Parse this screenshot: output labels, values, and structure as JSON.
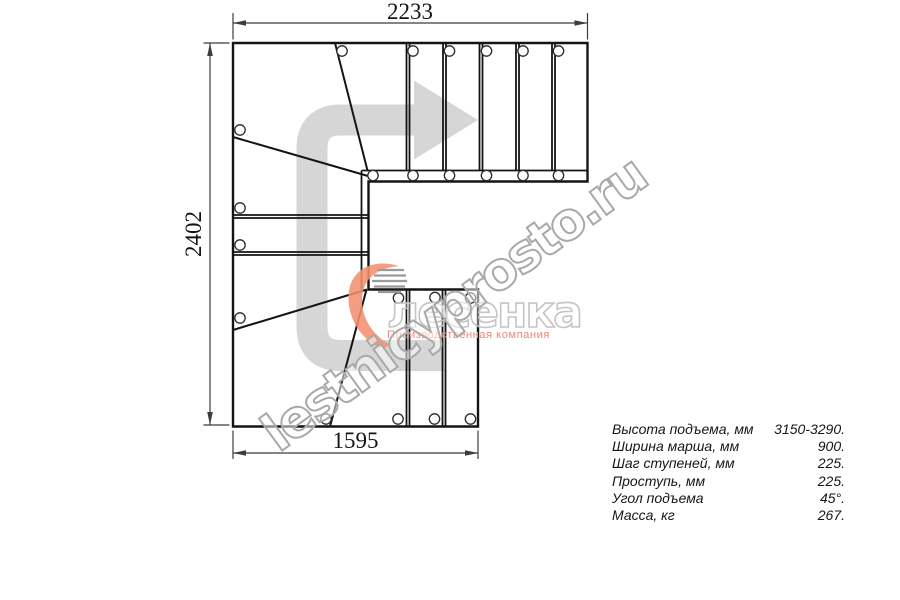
{
  "plan": {
    "dim_top": "2233",
    "dim_left": "2402",
    "dim_bottom": "1595"
  },
  "logo": {
    "title": "лесенка",
    "subtitle": "Производственная компания"
  },
  "watermark": {
    "text": "lestnicyprosto.ru"
  },
  "specs": {
    "rows": [
      {
        "label": "Высота подъема, мм",
        "value": "3150-3290."
      },
      {
        "label": "Ширина марша, мм",
        "value": "900."
      },
      {
        "label": "Шаг ступеней, мм",
        "value": "225."
      },
      {
        "label": "Проступь, мм",
        "value": "225."
      },
      {
        "label": "Угол подъема",
        "value": "45°."
      },
      {
        "label": "Масса, кг",
        "value": "267."
      }
    ]
  },
  "colors": {
    "plan_line": "#141414",
    "dimension_line": "#3c3c3c",
    "direction_arrow": "#d6d6d6",
    "logo_accent": "#f2906e",
    "logo_text_outline": "#c4c4c4",
    "logo_subtitle": "#ec8875",
    "watermark_outline": "#a9a9a9"
  }
}
